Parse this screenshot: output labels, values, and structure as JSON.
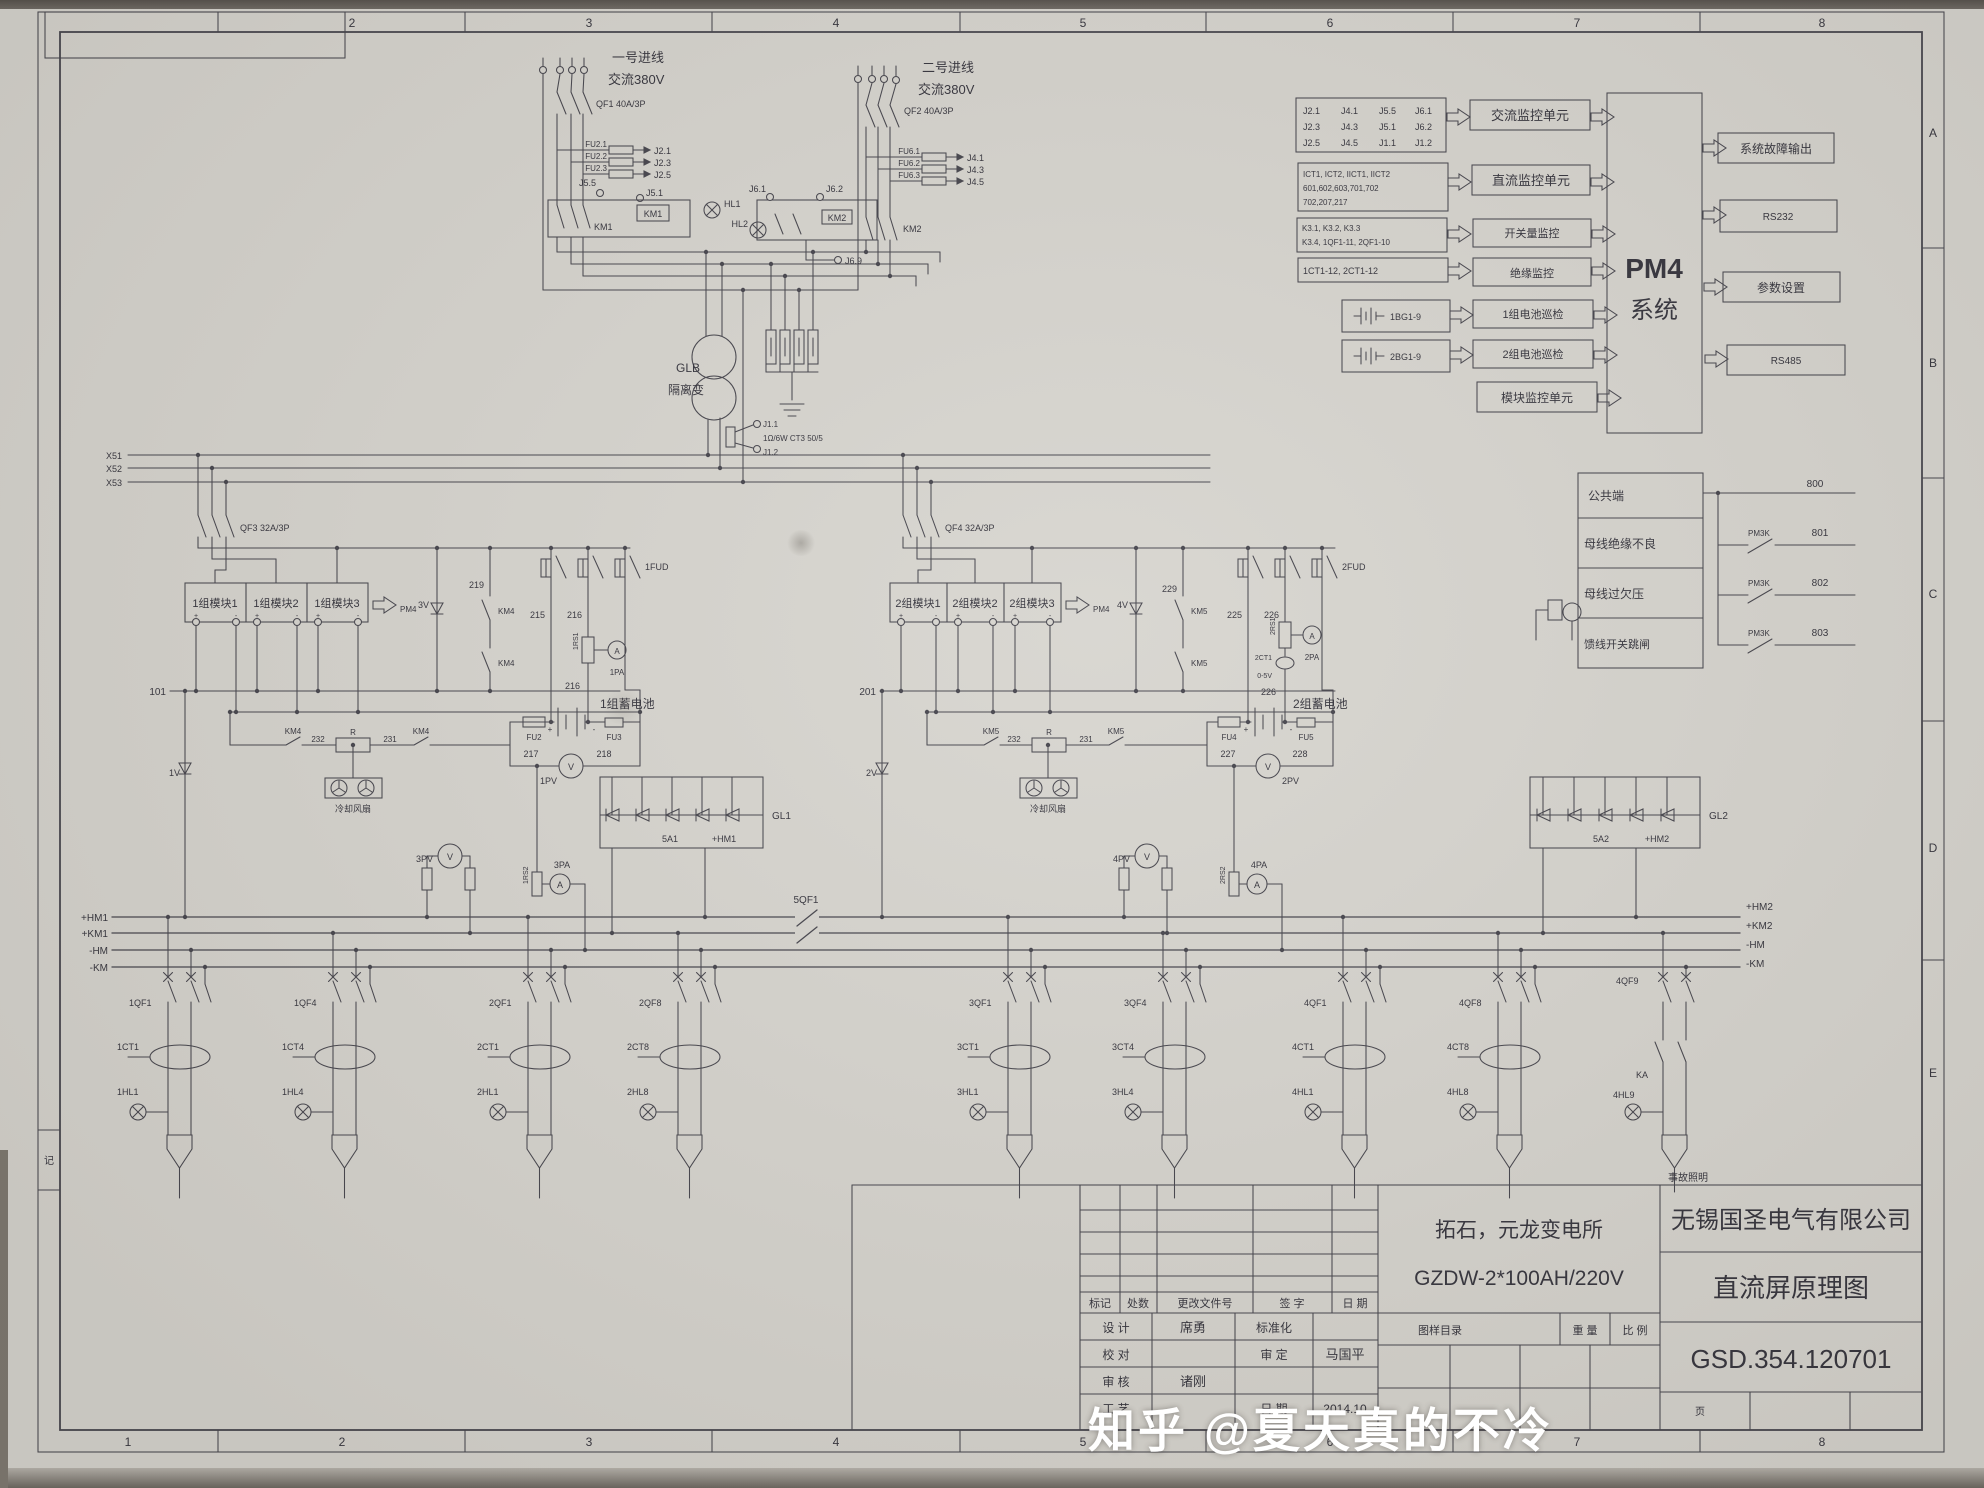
{
  "frame": {
    "ruler_top": [
      "2",
      "3",
      "4",
      "5",
      "6",
      "7",
      "8"
    ],
    "ruler_bottom": [
      "1",
      "2",
      "3",
      "4",
      "5",
      "6",
      "7",
      "8"
    ],
    "ruler_right": [
      "A",
      "B",
      "C",
      "D",
      "E"
    ],
    "left_marker": "记"
  },
  "incoming1": {
    "title": "一号进线",
    "subtitle": "交流380V",
    "breaker": "QF1 40A/3P",
    "fuse_labels": [
      "FU2.1",
      "FU2.2",
      "FU2.3"
    ],
    "j_out": [
      "J2.1",
      "J2.3",
      "J2.5"
    ],
    "j55": "J5.5",
    "j51": "J5.1",
    "km_coil": "KM1",
    "km_contact": "KM1",
    "hl1": "HL1",
    "hl2": "HL2"
  },
  "incoming2": {
    "title": "二号进线",
    "subtitle": "交流380V",
    "breaker": "QF2 40A/3P",
    "fuse_labels": [
      "FU6.1",
      "FU6.2",
      "FU6.3"
    ],
    "j_out": [
      "J4.1",
      "J4.3",
      "J4.5"
    ],
    "j61": "J6.1",
    "j62": "J6.2",
    "j69": "J6.9",
    "km_coil": "KM2",
    "km_contact": "KM2"
  },
  "transformer": {
    "name": "GLB",
    "type": "隔离变",
    "j11": "J1.1",
    "ct": "1Ω/6W CT3 50/5",
    "j12": "J1.2"
  },
  "ac_bus": [
    "X51",
    "X52",
    "X53"
  ],
  "group1": {
    "breaker": "QF3 32A/3P",
    "modules": [
      "1组模块1",
      "1组模块2",
      "1组模块3"
    ],
    "pm4": "PM4",
    "bus": "101",
    "v_diode": "1V",
    "d3v": "3V",
    "n219": "219",
    "km_a": "KM4",
    "km_b": "KM4",
    "f215": "215",
    "f216": "216",
    "fud": "1FUD",
    "shunt1": "1RS1",
    "pa1": "1PA",
    "n216b": "216",
    "battery": "1组蓄电池",
    "fu_l": "FU2",
    "fu_r": "FU3",
    "n217": "217",
    "n218": "218",
    "pv": "1PV",
    "km_c": "KM4",
    "n232": "232",
    "r": "R",
    "n231": "231",
    "km_d": "KM4",
    "fan": "冷却风扇",
    "pv_aux": "3PV",
    "shunt2": "1RS2",
    "pa_aux": "3PA",
    "gl": "GL1",
    "gl_a": "5A1",
    "gl_hm": "+HM1"
  },
  "group2": {
    "breaker": "QF4 32A/3P",
    "modules": [
      "2组模块1",
      "2组模块2",
      "2组模块3"
    ],
    "pm4": "PM4",
    "bus": "201",
    "v_diode": "2V",
    "d4v": "4V",
    "n229": "229",
    "km_a": "KM5",
    "km_b": "KM5",
    "f225": "225",
    "f226": "226",
    "fud": "2FUD",
    "shunt1": "2RS1",
    "pa1": "2PA",
    "ct": "2CT1",
    "ct_range": "0-5V",
    "n226b": "226",
    "battery": "2组蓄电池",
    "fu_l": "FU4",
    "fu_r": "FU5",
    "n227": "227",
    "n228": "228",
    "pv": "2PV",
    "km_c": "KM5",
    "n232": "232",
    "r": "R",
    "n231": "231",
    "km_d": "KM5",
    "fan": "冷却风扇",
    "pv_aux": "4PV",
    "shunt2": "2RS2",
    "pa_aux": "4PA",
    "gl": "GL2",
    "gl_a": "5A2",
    "gl_hm": "+HM2"
  },
  "dc_bus": {
    "left": [
      "+HM1",
      "+KM1",
      "-HM",
      "-KM"
    ],
    "right": [
      "+HM2",
      "+KM2",
      "-HM",
      "-KM"
    ],
    "tie": "5QF1"
  },
  "feeders": [
    {
      "qf": "1QF1",
      "ct": "1CT1",
      "hl": "1HL1"
    },
    {
      "qf": "1QF4",
      "ct": "1CT4",
      "hl": "1HL4"
    },
    {
      "qf": "2QF1",
      "ct": "2CT1",
      "hl": "2HL1"
    },
    {
      "qf": "2QF8",
      "ct": "2CT8",
      "hl": "2HL8"
    },
    {
      "qf": "3QF1",
      "ct": "3CT1",
      "hl": "3HL1"
    },
    {
      "qf": "3QF4",
      "ct": "3CT4",
      "hl": "3HL4"
    },
    {
      "qf": "4QF1",
      "ct": "4CT1",
      "hl": "4HL1"
    },
    {
      "qf": "4QF8",
      "ct": "4CT8",
      "hl": "4HL8"
    },
    {
      "qf": "4QF9",
      "ka": "KA",
      "hl": "4HL9",
      "note": "事故照明"
    }
  ],
  "pm4": {
    "inputs": [
      {
        "cells": [
          [
            "J2.1",
            "J4.1",
            "J5.5",
            "J6.1"
          ],
          [
            "J2.3",
            "J4.3",
            "J5.1",
            "J6.2"
          ],
          [
            "J2.5",
            "J4.5",
            "J1.1",
            "J1.2"
          ]
        ],
        "unit": "交流监控单元"
      },
      {
        "rows": [
          "ICT1, ICT2, IICT1, IICT2",
          "601,602,603,701,702",
          "702,207,217"
        ],
        "unit": "直流监控单元"
      },
      {
        "rows": [
          "K3.1, K3.2, K3.3",
          "K3.4, 1QF1-11, 2QF1-10"
        ],
        "unit": "开关量监控"
      },
      {
        "rows": [
          "1CT1-12, 2CT1-12"
        ],
        "unit": "绝缘监控"
      },
      {
        "battery": "1BG1-9",
        "unit": "1组电池巡检"
      },
      {
        "battery": "2BG1-9",
        "unit": "2组电池巡检"
      },
      {
        "unit": "模块监控单元"
      }
    ],
    "name_line1": "PM4",
    "name_line2": "系统",
    "outputs": [
      "系统故障输出",
      "RS232",
      "参数设置",
      "RS485"
    ]
  },
  "alarms": {
    "rows": [
      "公共端",
      "母线绝缘不良",
      "母线过欠压",
      "馈线开关跳闸"
    ],
    "relay": "PM3K",
    "nums": [
      "800",
      "801",
      "802",
      "803"
    ]
  },
  "title_block": {
    "mark": "标记",
    "count": "处数",
    "doc_no": "更改文件号",
    "sign": "签  字",
    "date_h": "日  期",
    "design": "设  计",
    "designer": "席勇",
    "standard": "标准化",
    "check": "校  对",
    "approve": "审  定",
    "approver": "马国平",
    "audit": "审  核",
    "auditor": "诸刚",
    "craft": "工  艺",
    "date_l": "日  期",
    "date_v": "2014.10",
    "catalog": "图样目录",
    "weight": "重  量",
    "scale": "比  例",
    "project": "拓石，元龙变电所",
    "model": "GZDW-2*100AH/220V",
    "company": "无锡国圣电气有限公司",
    "drawing": "直流屏原理图",
    "number": "GSD.354.120701",
    "page": "页"
  },
  "watermark": "知乎 @夏天真的不冷",
  "symbols": {
    "plus": "+",
    "minus": "-",
    "v": "V",
    "a": "A"
  }
}
